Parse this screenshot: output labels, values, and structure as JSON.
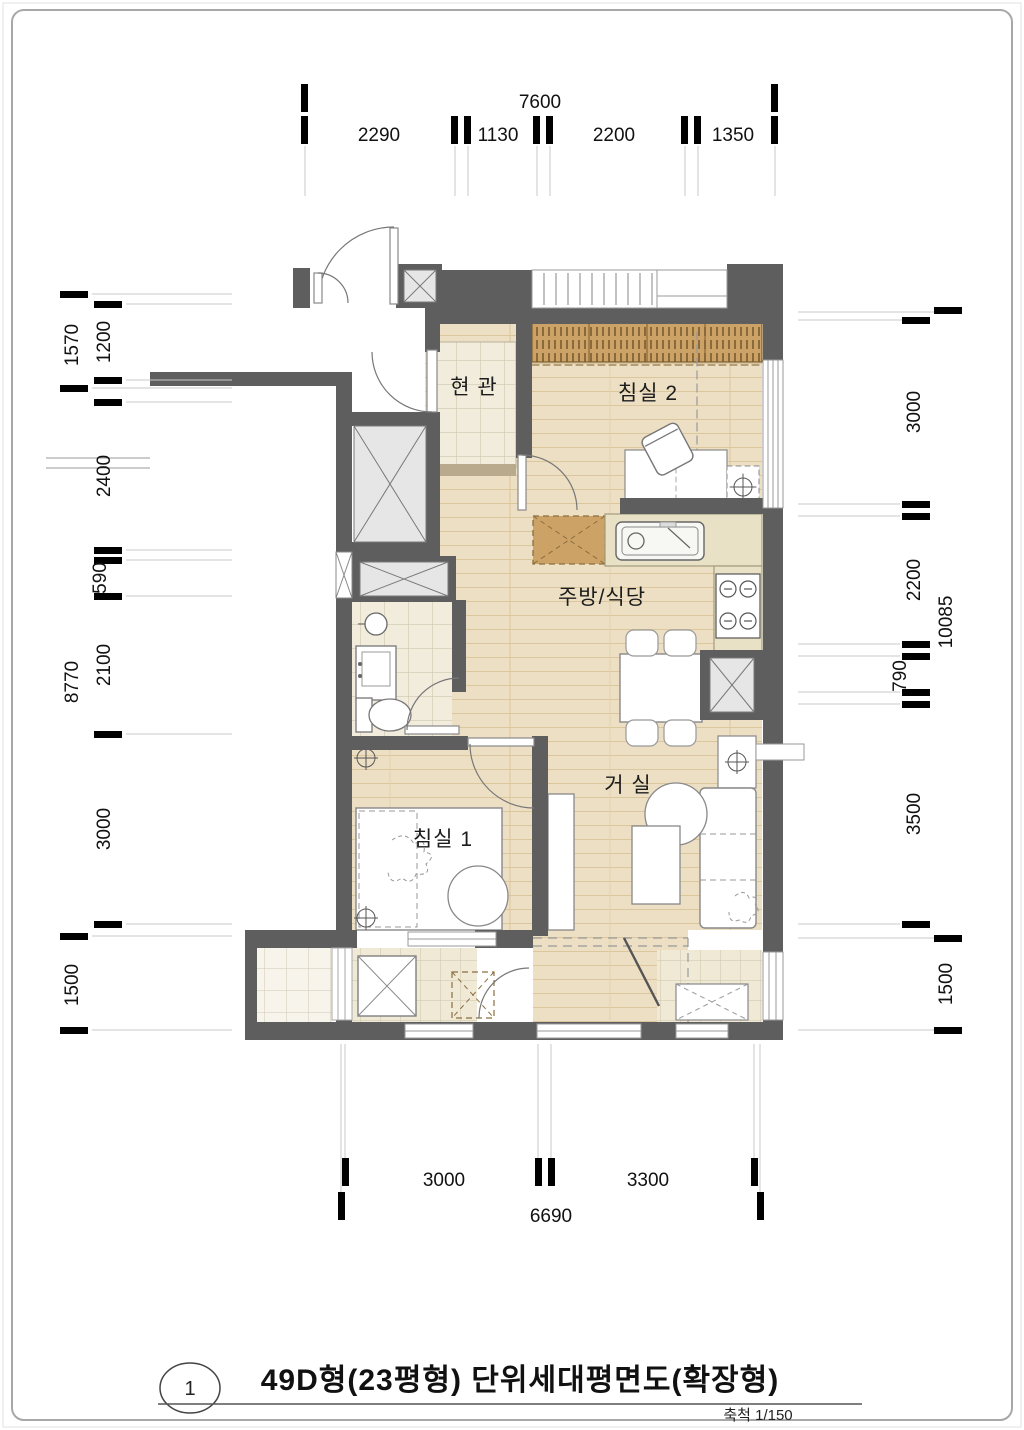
{
  "page": {
    "title_number": "1",
    "title": "49D형(23평형) 단위세대평면도(확장형)",
    "scale_label": "축척 1/150"
  },
  "rooms": {
    "entry": "현 관",
    "bedroom2": "침실 2",
    "kitchen_dining": "주방/식당",
    "living": "거 실",
    "bedroom1": "침실 1"
  },
  "dimensions": {
    "top": {
      "total": "7600",
      "segments": [
        "2290",
        "1130",
        "2200",
        "1350"
      ]
    },
    "left": {
      "outer": [
        "1570",
        "8770",
        "1500"
      ],
      "inner": [
        "1200",
        "2400",
        "590",
        "2100",
        "3000"
      ]
    },
    "right": {
      "outer": [
        "10085",
        "1500"
      ],
      "inner": [
        "3000",
        "2200",
        "790",
        "3500"
      ]
    },
    "bottom": {
      "total": "6690",
      "segments": [
        "3000",
        "3300"
      ]
    }
  },
  "colors": {
    "wall": "#5e5e5e",
    "wood_floor": "#ecdfc3",
    "tile_floor": "#f1ecdc",
    "balcony_tile": "#efe9d6",
    "furniture_wood": "#c89c5e",
    "counter": "#e9e1c6",
    "shaft_gray": "#e6e6e6"
  }
}
